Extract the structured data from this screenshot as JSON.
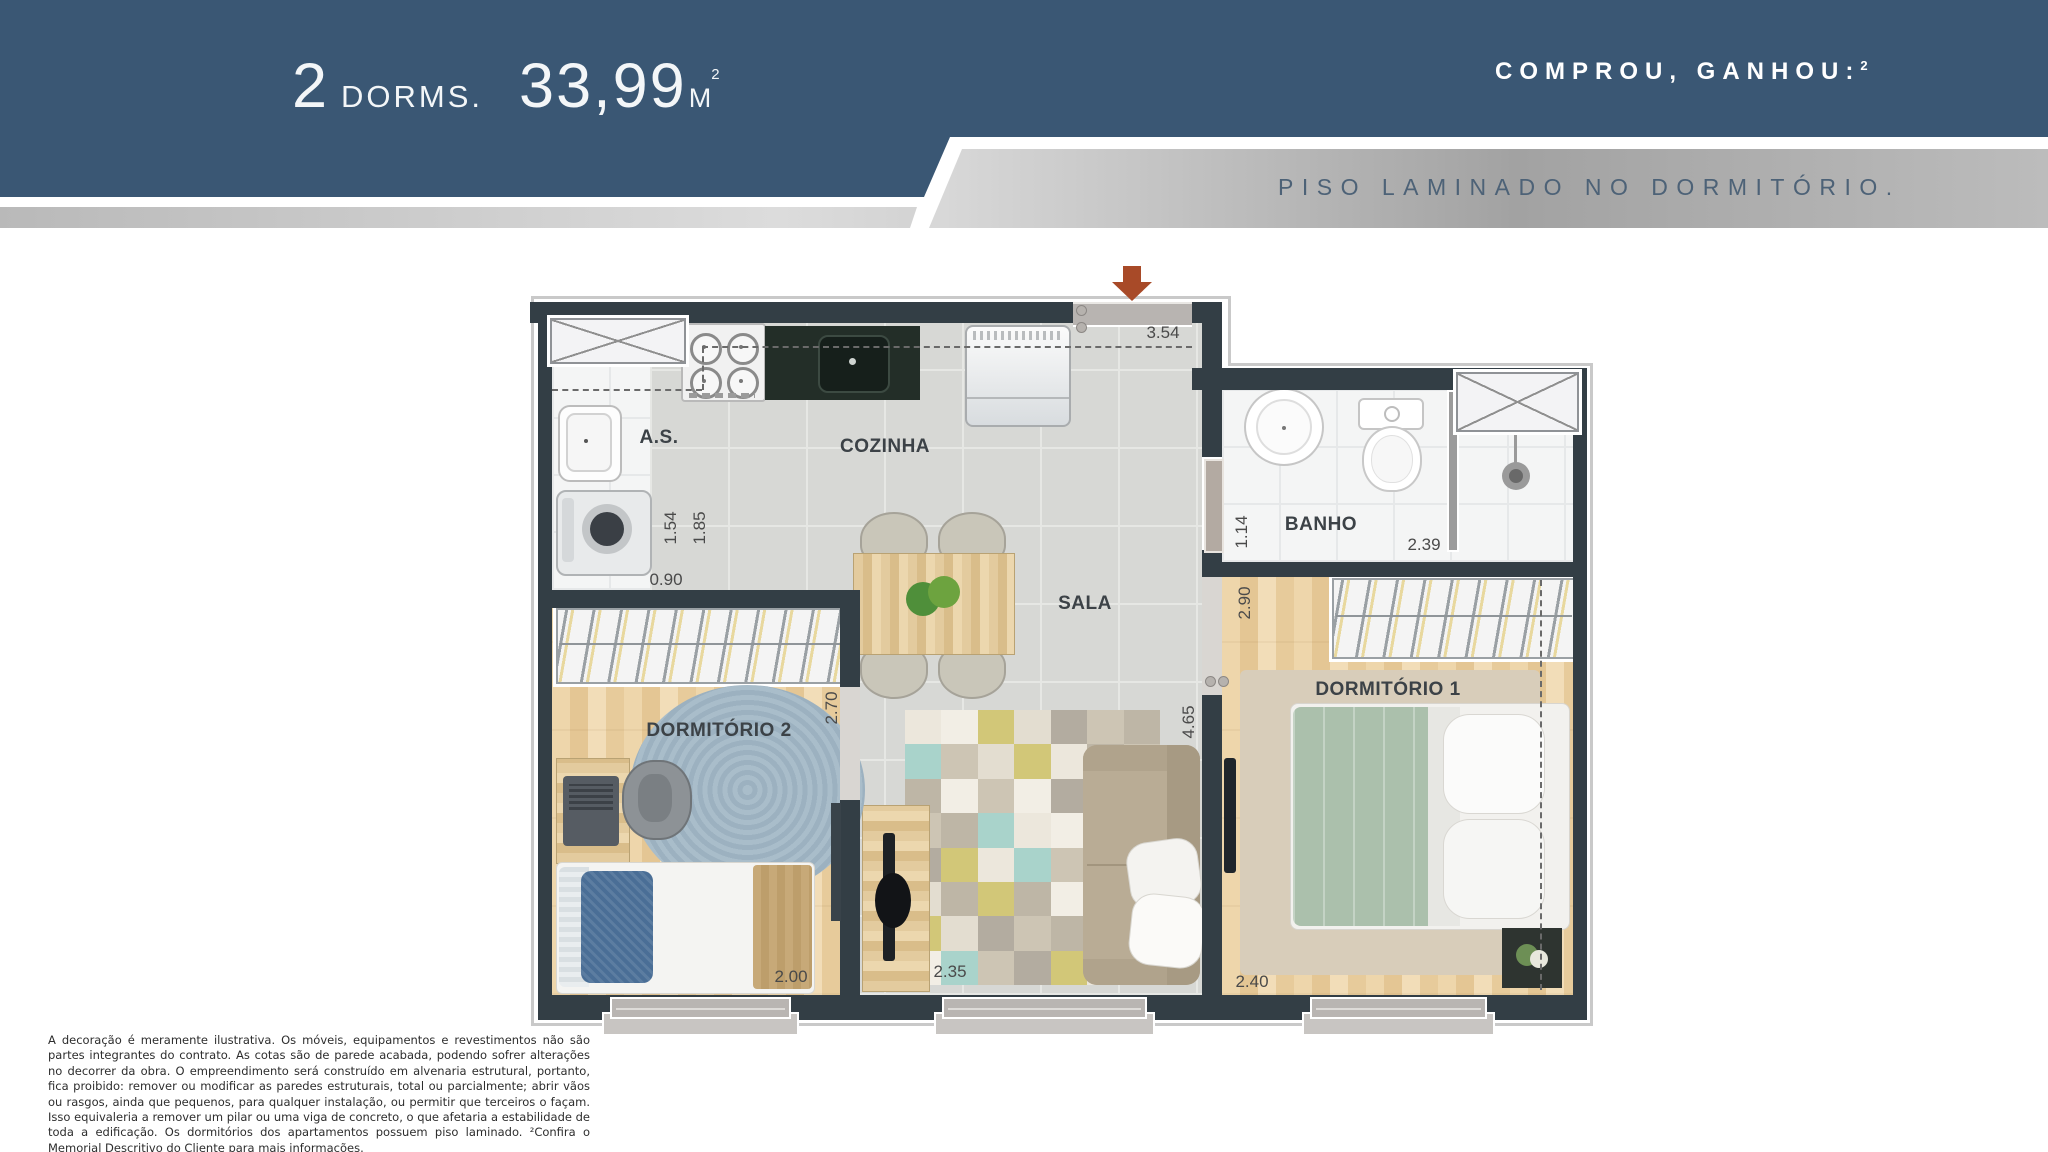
{
  "header": {
    "title": {
      "units": "2",
      "units_label": "DORMS.",
      "area": "33,99",
      "area_unit": "M",
      "area_sup": "2"
    },
    "promo": {
      "text": "COMPROU, GANHOU:",
      "sup": "2"
    },
    "ribbon_text": "PISO LAMINADO NO DORMITÓRIO."
  },
  "plan": {
    "rooms": [
      {
        "id": "as",
        "label": "A.S."
      },
      {
        "id": "cozinha",
        "label": "COZINHA"
      },
      {
        "id": "sala",
        "label": "SALA"
      },
      {
        "id": "banho",
        "label": "BANHO"
      },
      {
        "id": "dorm1",
        "label": "DORMITÓRIO 1"
      },
      {
        "id": "dorm2",
        "label": "DORMITÓRIO 2"
      }
    ],
    "dimensions": [
      {
        "id": "entry-width",
        "value": "3.54"
      },
      {
        "id": "as-depth",
        "value": "1.54"
      },
      {
        "id": "kitchen-depth",
        "value": "1.85"
      },
      {
        "id": "as-width",
        "value": "0.90"
      },
      {
        "id": "banho-width",
        "value": "1.14"
      },
      {
        "id": "banho-length",
        "value": "2.39"
      },
      {
        "id": "dorm1-depth",
        "value": "2.90"
      },
      {
        "id": "dorm2-depth",
        "value": "2.70"
      },
      {
        "id": "sala-depth",
        "value": "4.65"
      },
      {
        "id": "dorm2-width",
        "value": "2.00"
      },
      {
        "id": "sala-width",
        "value": "2.35"
      },
      {
        "id": "dorm1-width",
        "value": "2.40"
      }
    ]
  },
  "footer": {
    "disclaimer": "A decoração é meramente ilustrativa. Os móveis, equipamentos e revestimentos não são partes integrantes do contrato. As cotas são de parede acabada, podendo sofrer alterações no decorrer da obra. O empreendimento será construído em alvenaria estrutural, portanto, fica proibido: remover ou modificar as paredes estruturais, total ou parcialmente; abrir vãos ou rasgos, ainda que pequenos, para qualquer instalação, ou permitir que terceiros o façam. Isso equivaleria a remover um pilar ou uma viga de concreto, o que afetaria a estabilidade de toda a edificação. Os dormitórios dos apartamentos possuem piso laminado.  ²Confira o Memorial Descritivo do Cliente para mais informações."
  },
  "colors": {
    "header_blue": "#3a5774",
    "ribbon_text": "#4d6277",
    "wall": "#333e45",
    "entry_arrow": "#a84a28",
    "wood_floor": "#e8cf9f",
    "duvet_green": "#abc0ac",
    "sofa_taupe": "#b9ac95",
    "rug_blue": "#a4b9c7",
    "patchwork": [
      "#ece7dc",
      "#cdc5b4",
      "#d2c778",
      "#a9d3cb",
      "#b3aca0",
      "#f2eee5",
      "#beb6a6",
      "#e3ddd0"
    ]
  }
}
